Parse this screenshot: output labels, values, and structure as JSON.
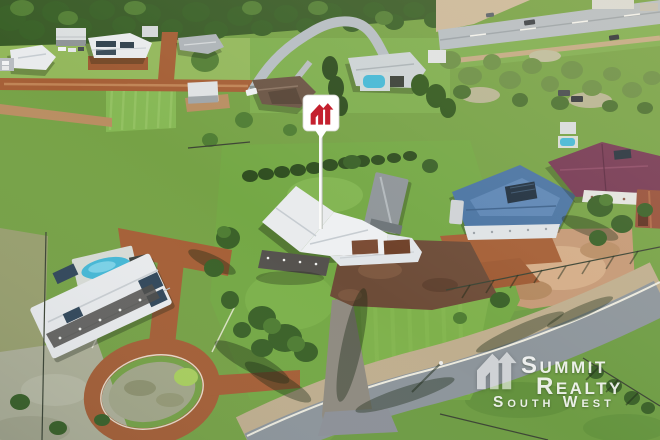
{
  "watermark": {
    "brand_line1": "Summit",
    "brand_line2": "Realty",
    "brand_line3": "South West"
  },
  "marker": {
    "glyph": "summit-realty-house-logo",
    "pin_background": "#ffffff",
    "glyph_color": "#c4202e",
    "pole_color": "#fafaf8"
  },
  "palette": {
    "grass": "#76a246",
    "lawn_bright": "#7fb14c",
    "scrub": "#9aa272",
    "dirt_road": "#a55f36",
    "gravel_court": "#6d4c38",
    "bare_earth": "#c59976",
    "asphalt": "#8d959b",
    "highway": "#b6bdc3",
    "roof_white": "#e9ebed",
    "roof_blue": "#4a74a3",
    "roof_maroon": "#763954",
    "shed_rust": "#97503a",
    "pool_blue": "#45b8d6",
    "tree_green": "#3a6128"
  }
}
